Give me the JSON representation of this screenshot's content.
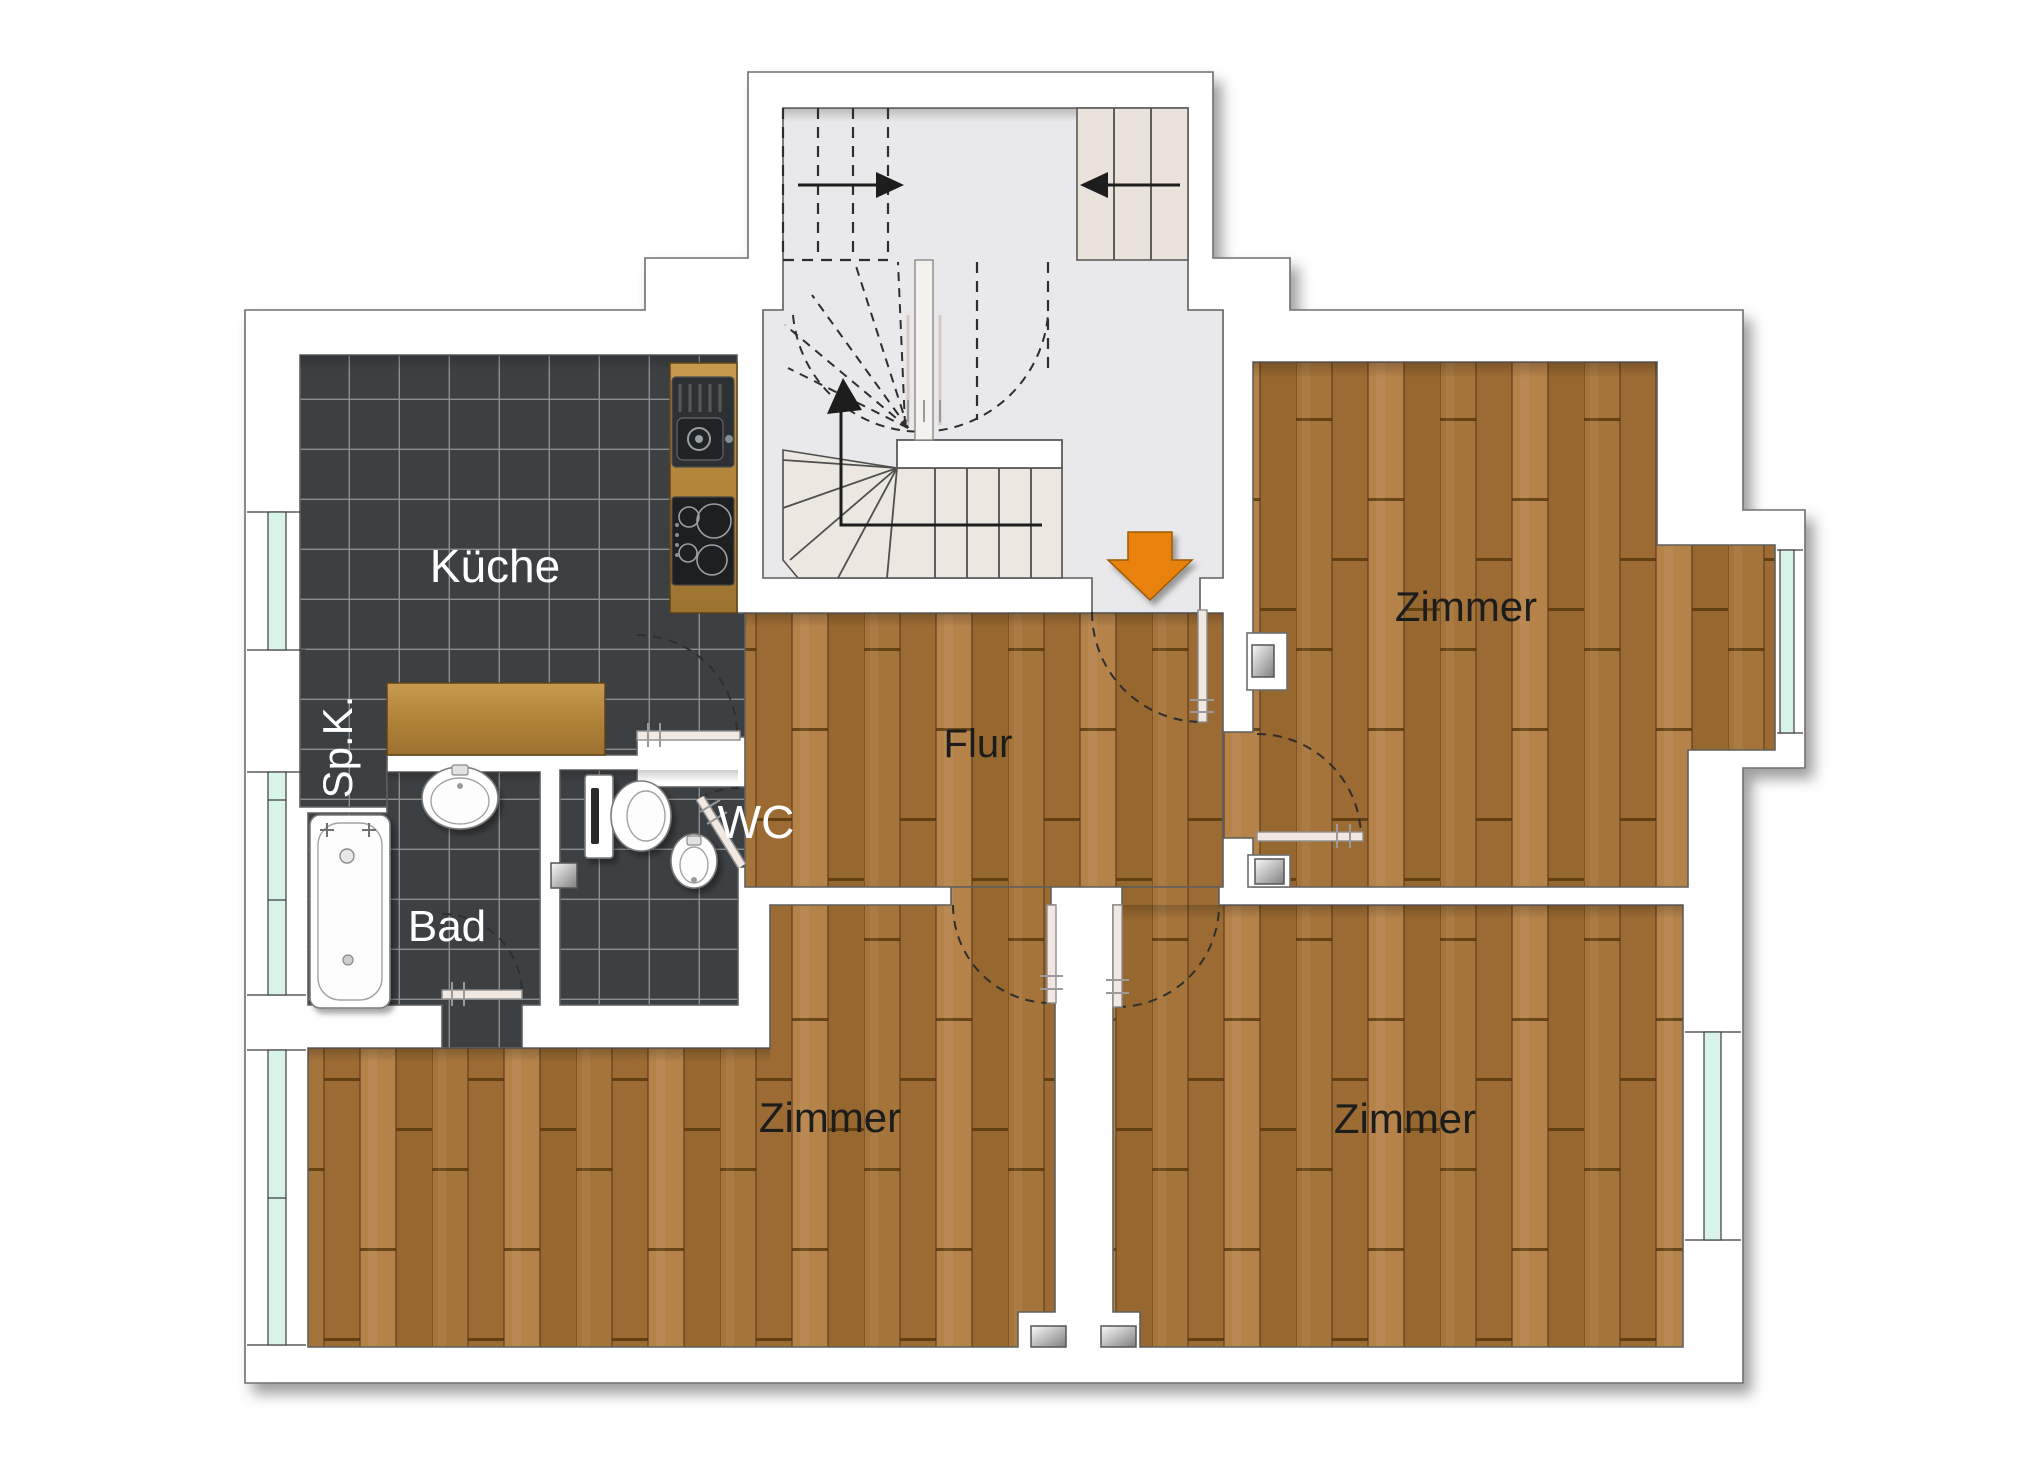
{
  "rooms": {
    "kueche": {
      "label": "Küche"
    },
    "spk": {
      "label": "Sp.K."
    },
    "bad": {
      "label": "Bad"
    },
    "wc": {
      "label": "WC"
    },
    "flur": {
      "label": "Flur"
    },
    "zimmer_top_right": {
      "label": "Zimmer"
    },
    "zimmer_bottom_left": {
      "label": "Zimmer"
    },
    "zimmer_bottom_right": {
      "label": "Zimmer"
    }
  },
  "colors": {
    "wood_floor": "#a9773e",
    "tile_floor": "#3d4043",
    "stair_floor": "#e9e9eb",
    "stair_treads": "#ebe6e0",
    "window_glass": "#d8f3e8",
    "entrance_arrow": "#e8820e",
    "wall_fill": "#ffffff",
    "wall_outline": "#6e6e6e"
  },
  "icons": {
    "entrance_arrow": "down-arrow",
    "stair_up_arrow": "right-arrow",
    "stair_down_arrow": "left-arrow"
  }
}
